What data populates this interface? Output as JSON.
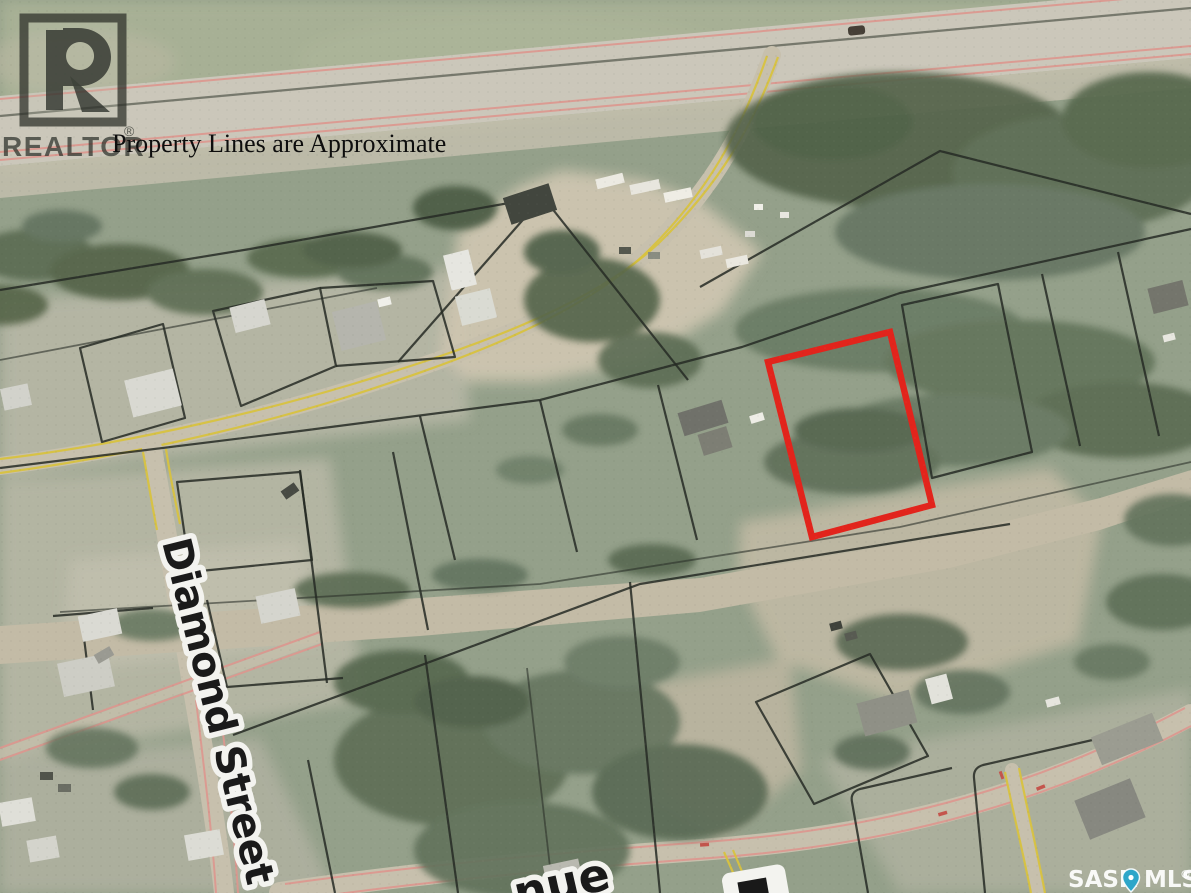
{
  "image_type": "aerial-parcel-map-listing-photo",
  "disclaimer": {
    "text": "Property Lines are Approximate"
  },
  "branding": {
    "realtor_logo_letter": "R",
    "realtor_wordmark": "REALTOR",
    "realtor_registered": "®"
  },
  "street_labels": {
    "vertical_street": "Diamond Street",
    "bottom_partial_avenue": "nue"
  },
  "footer_watermark": {
    "left": "SASK",
    "right": "MLS",
    "registered": "®",
    "pin_icon": "map-pin-icon"
  },
  "subject_property": {
    "marking": "red-outline",
    "outline_color": "#e2241c"
  },
  "colors": {
    "grass_base": "#94a08a",
    "field_light": "#a7b095",
    "trees": "#5a6a51",
    "dirt_road": "#c3bba6",
    "pavement": "#cbc7ba",
    "road_edge_pink": "#dd968e",
    "road_edge_yellow": "#d8c23f",
    "parcel_line": "#262a24"
  }
}
